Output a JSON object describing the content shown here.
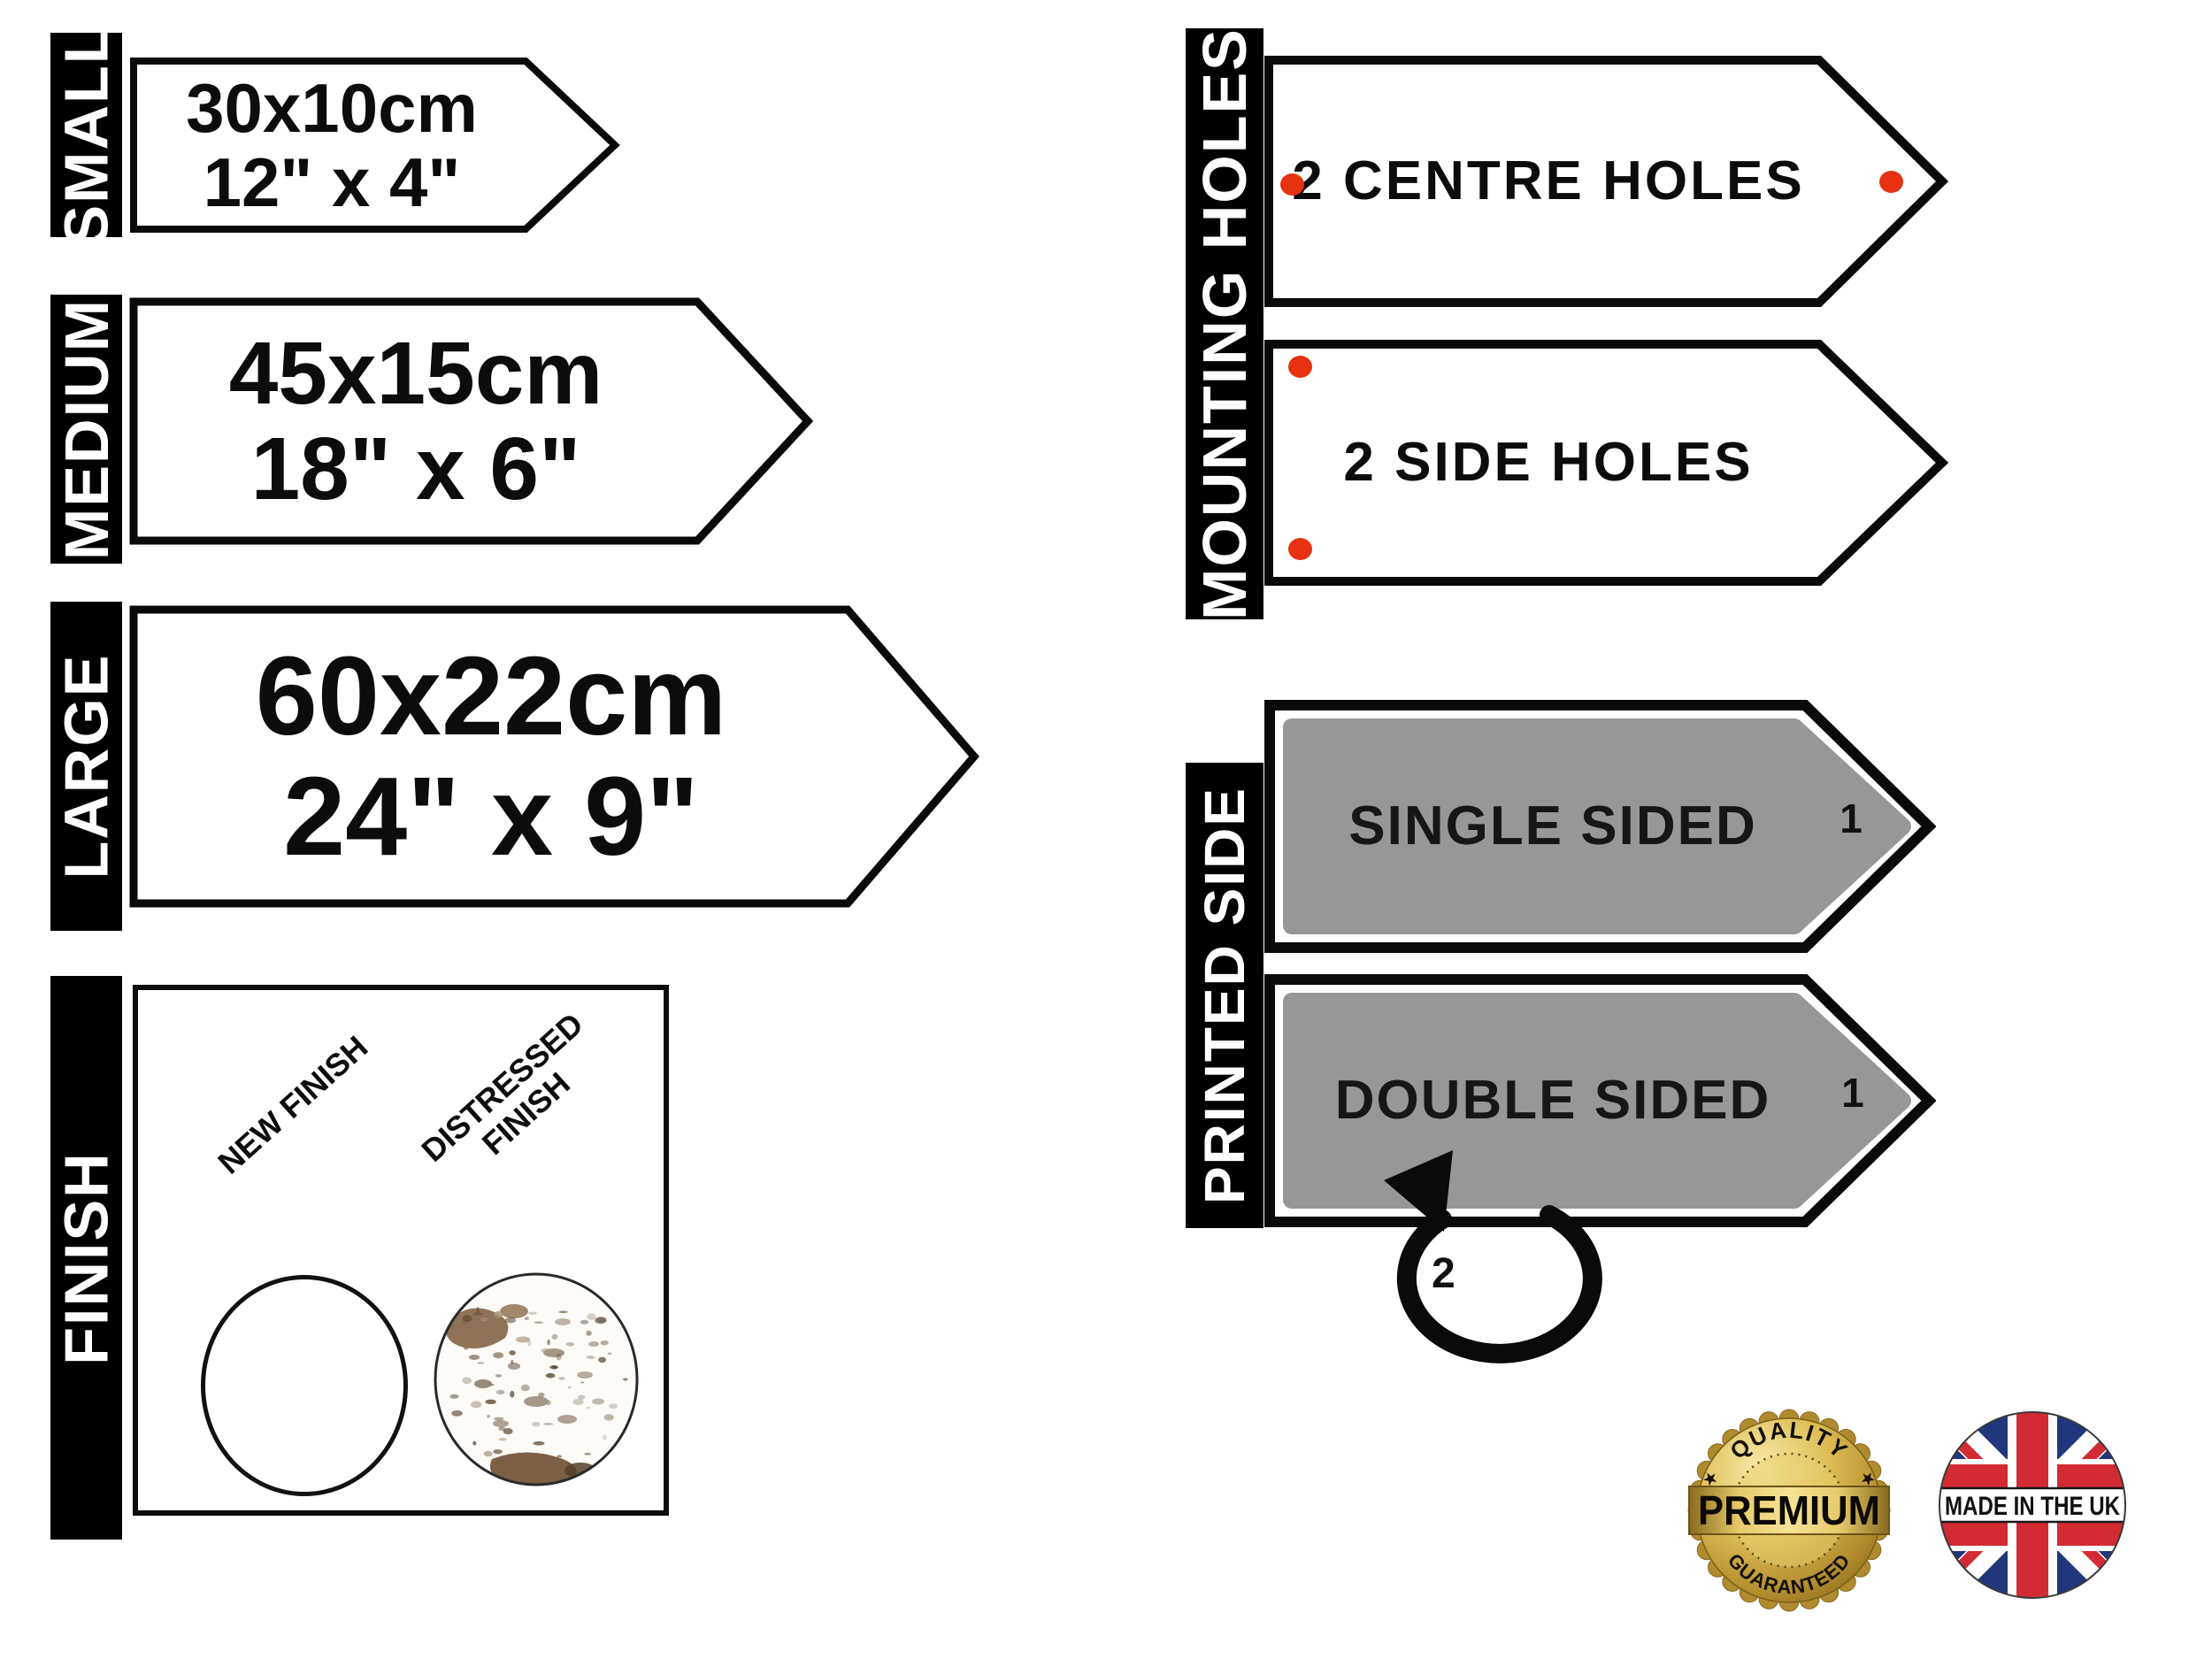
{
  "size_options": [
    {
      "label": "SMALL",
      "dimension_cm": "30x10cm",
      "dimension_in": "12\" x 4\""
    },
    {
      "label": "MEDIUM",
      "dimension_cm": "45x15cm",
      "dimension_in": "18\" x 6\""
    },
    {
      "label": "LARGE",
      "dimension_cm": "60x22cm",
      "dimension_in": "24\" x 9\""
    }
  ],
  "finish_section": {
    "label": "FINISH",
    "options": [
      {
        "name": "NEW FINISH"
      },
      {
        "name": "DISTRESSED FINISH"
      }
    ]
  },
  "mounting_section": {
    "label": "MOUNTING HOLES",
    "options": [
      {
        "name": "2 CENTRE HOLES",
        "holes": 2
      },
      {
        "name": "2 SIDE HOLES",
        "holes": 2
      }
    ]
  },
  "printed_section": {
    "label": "PRINTED SIDE",
    "options": [
      {
        "name": "SINGLE SIDED",
        "side_number": "1"
      },
      {
        "name": "DOUBLE SIDED",
        "side_number": "1",
        "flip_number": "2"
      }
    ]
  },
  "badges": {
    "premium": {
      "arc_top": "QUALITY",
      "center": "PREMIUM",
      "arc_bottom": "GUARANTEED"
    },
    "made_in_uk": {
      "text": "MADE IN THE UK"
    }
  },
  "colors": {
    "accent_red": "#e73212",
    "sign_grey": "#979797",
    "flag_navy": "#20377b",
    "flag_red": "#d22b33",
    "badge_gold": "#caa53d",
    "bar_black": "#000000"
  }
}
